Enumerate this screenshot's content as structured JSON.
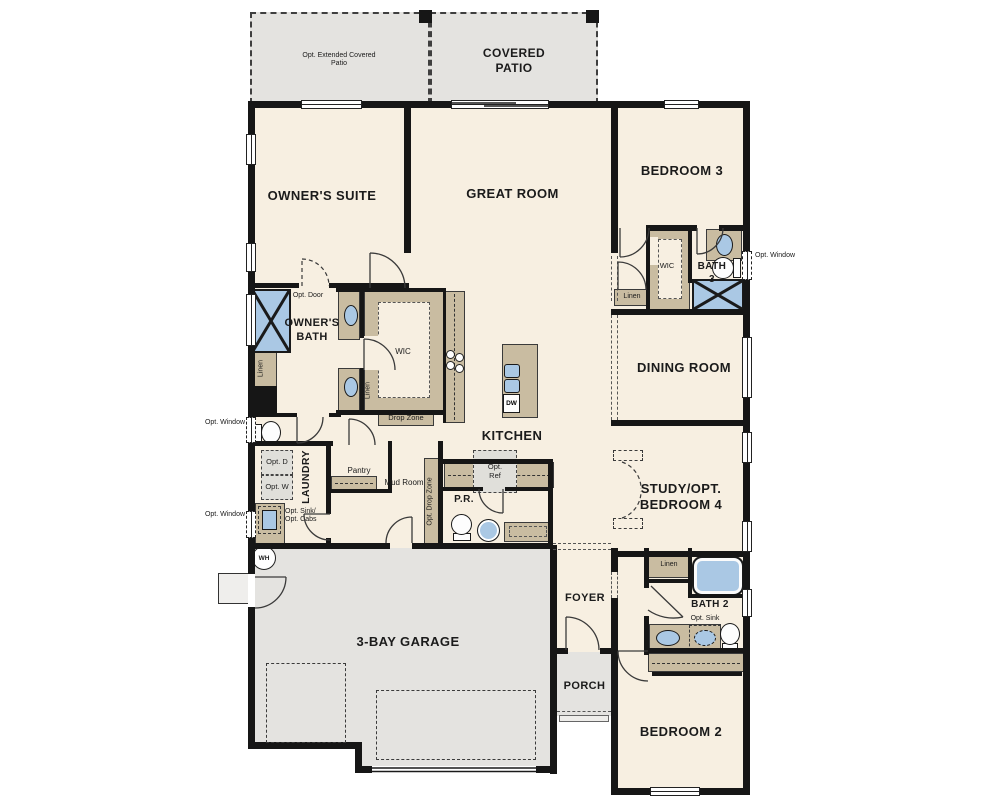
{
  "palette": {
    "cream": "#f7efe1",
    "tan": "#c9bca1",
    "gray": "#e4e3e0",
    "blue": "#aac8e4",
    "wall": "#161616",
    "optbox": "#e0dfda"
  },
  "labels": {
    "ext_patio": "Opt. Extended Covered Patio",
    "covered_patio": "COVERED PATIO",
    "owners_suite": "OWNER'S SUITE",
    "great_room": "GREAT ROOM",
    "bedroom3": "BEDROOM 3",
    "dining_room": "DINING ROOM",
    "study": "STUDY/OPT. BEDROOM 4",
    "kitchen": "KITCHEN",
    "garage": "3-BAY GARAGE",
    "bedroom2": "BEDROOM 2",
    "foyer": "FOYER",
    "porch": "PORCH",
    "bath2": "BATH 2",
    "bath3": "BATH 3",
    "owners_bath": "OWNER'S BATH",
    "laundry": "LAUNDRY",
    "pantry": "Pantry",
    "mud_room": "Mud Room",
    "pr": "P.R.",
    "wic": "WIC",
    "linen": "Linen",
    "drop_zone": "Drop Zone",
    "opt_drop_zone": "Opt. Drop Zone",
    "opt_door": "Opt. Door",
    "opt_window": "Opt. Window",
    "opt_d": "Opt. D",
    "opt_w": "Opt. W",
    "opt_sink_line1": "Opt. Sink/",
    "opt_sink_line2": "Opt. Cabs",
    "opt_sink": "Opt. Sink",
    "opt_ref1": "Opt.",
    "opt_ref2": "Ref",
    "wh": "WH",
    "dw": "DW"
  }
}
